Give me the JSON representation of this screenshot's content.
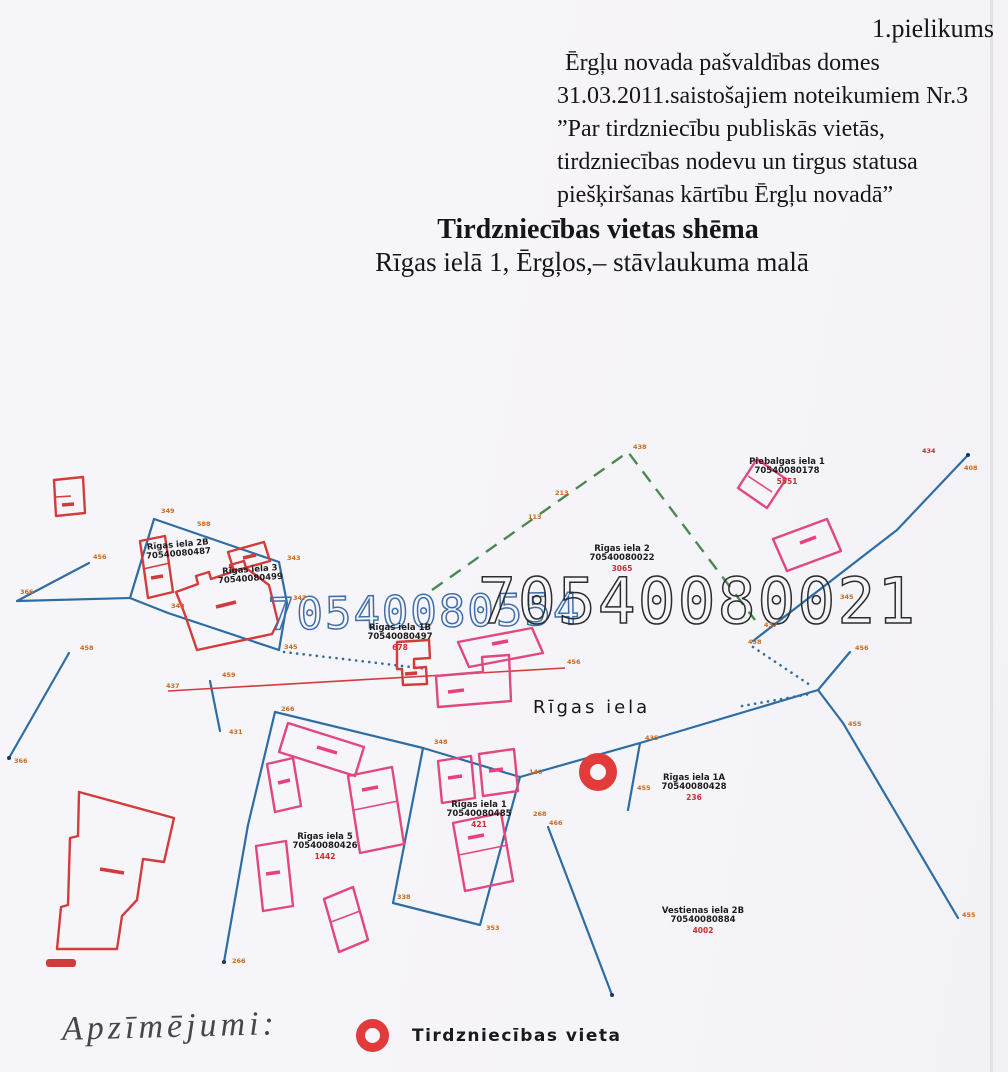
{
  "header": {
    "appendix": "1.pielikums",
    "lines": [
      "Ērgļu novada pašvaldības domes",
      "31.03.2011.saistošajiem noteikumiem Nr.3",
      "”Par tirdzniecību publiskās vietās,",
      "tirdzniecības nodevu un tirgus statusa",
      "piešķiršanas kārtību  Ērgļu novadā”"
    ]
  },
  "title": {
    "main": "Tirdzniecības vietas shēma",
    "location": "Rīgas ielā 1, Ērgļos,– stāvlaukuma malā"
  },
  "map": {
    "street_label": "Rīgas iela",
    "cadastral_number_blue": "70540080554",
    "cadastral_number_black": "70540080021",
    "marker_symbol": "red-donut",
    "parcels": [
      {
        "name": "Rīgas iela 2B",
        "cadastre": "70540080487",
        "x": 178,
        "y": 547,
        "rot": -5
      },
      {
        "name": "Rīgas iela 3",
        "cadastre": "70540080499",
        "x": 250,
        "y": 572,
        "rot": -4
      },
      {
        "name": "Rīgas iela 1B",
        "cadastre": "70540080497",
        "note": "678",
        "x": 400,
        "y": 630
      },
      {
        "name": "Rīgas iela 2",
        "cadastre": "70540080022",
        "note": "3065",
        "x": 622,
        "y": 551
      },
      {
        "name": "Piebalgas iela 1",
        "cadastre": "70540080178",
        "note": "5551",
        "x": 787,
        "y": 464
      },
      {
        "name": "Rīgas iela 1A",
        "cadastre": "70540080428",
        "note": "236",
        "x": 694,
        "y": 780
      },
      {
        "name": "Rīgas iela 1",
        "cadastre": "70540080485",
        "note": "421",
        "x": 479,
        "y": 807
      },
      {
        "name": "Rīgas iela 5",
        "cadastre": "70540080426",
        "note": "1442",
        "x": 325,
        "y": 839
      },
      {
        "name": "Vestienas iela 2B",
        "cadastre": "70540080884",
        "note": "4002",
        "x": 703,
        "y": 913
      }
    ],
    "vertex_labels": [
      {
        "t": "366",
        "x": 20,
        "y": 594
      },
      {
        "t": "456",
        "x": 93,
        "y": 559
      },
      {
        "t": "349",
        "x": 161,
        "y": 513
      },
      {
        "t": "588",
        "x": 197,
        "y": 526
      },
      {
        "t": "343",
        "x": 287,
        "y": 560
      },
      {
        "t": "347",
        "x": 293,
        "y": 600
      },
      {
        "t": "345",
        "x": 284,
        "y": 649
      },
      {
        "t": "348",
        "x": 171,
        "y": 608
      },
      {
        "t": "458",
        "x": 80,
        "y": 650
      },
      {
        "t": "459",
        "x": 222,
        "y": 677
      },
      {
        "t": "431",
        "x": 229,
        "y": 734
      },
      {
        "t": "266",
        "x": 281,
        "y": 711
      },
      {
        "t": "348",
        "x": 434,
        "y": 744
      },
      {
        "t": "140",
        "x": 529,
        "y": 774
      },
      {
        "t": "338",
        "x": 397,
        "y": 899
      },
      {
        "t": "353",
        "x": 486,
        "y": 930
      },
      {
        "t": "268",
        "x": 533,
        "y": 816
      },
      {
        "t": "366",
        "x": 14,
        "y": 763
      },
      {
        "t": "266",
        "x": 232,
        "y": 963
      },
      {
        "t": "438",
        "x": 633,
        "y": 449
      },
      {
        "t": "213",
        "x": 555,
        "y": 495
      },
      {
        "t": "113",
        "x": 528,
        "y": 519
      },
      {
        "t": "435",
        "x": 645,
        "y": 740
      },
      {
        "t": "456",
        "x": 855,
        "y": 650
      },
      {
        "t": "455",
        "x": 848,
        "y": 726
      },
      {
        "t": "408",
        "x": 964,
        "y": 470
      },
      {
        "t": "434",
        "x": 922,
        "y": 453,
        "red": true
      },
      {
        "t": "438",
        "x": 748,
        "y": 644
      },
      {
        "t": "437",
        "x": 764,
        "y": 627
      },
      {
        "t": "455",
        "x": 637,
        "y": 790
      },
      {
        "t": "455",
        "x": 962,
        "y": 917
      },
      {
        "t": "466",
        "x": 549,
        "y": 825
      },
      {
        "t": "437",
        "x": 166,
        "y": 688
      },
      {
        "t": "456",
        "x": 567,
        "y": 664
      },
      {
        "t": "345",
        "x": 840,
        "y": 599
      }
    ]
  },
  "legend": {
    "heading": "Apzīmējumi:",
    "items": [
      {
        "symbol": "red-donut",
        "label": "Tirdzniecības vieta"
      }
    ]
  },
  "colors": {
    "parcel_line": "#2e6da4",
    "boundary_dashed_green": "#4a8a52",
    "building_red": "#d43c3c",
    "building_pink": "#e0487e",
    "vertex_orange": "#c96a1e",
    "marker_red": "#e23b3b"
  }
}
